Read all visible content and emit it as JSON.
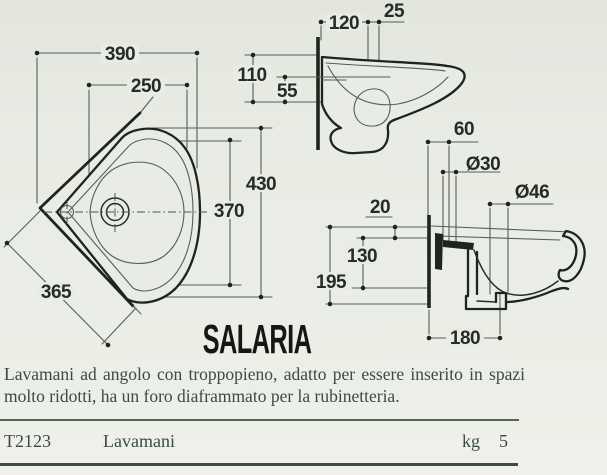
{
  "product": {
    "title": "SALARIA",
    "description": "Lavamani ad angolo con troppopieno, adatto per essere inserito in spazi molto ridotti, ha un foro diaframmato per la rubinetteria.",
    "table": {
      "code": "T2123",
      "name": "Lavamani",
      "unit_label": "kg",
      "weight": "5"
    }
  },
  "dimensions": {
    "plan": {
      "width": "390",
      "inner_width": "250",
      "depth": "430",
      "inner_depth": "370",
      "side": "365"
    },
    "side": {
      "tap_offset": "120",
      "tap_hole": "25",
      "height": "110",
      "lip": "55"
    },
    "section": {
      "drain_offset": "60",
      "drain_dia": "Ø30",
      "trap_dia": "Ø46",
      "fix_gap": "20",
      "drain_height": "130",
      "height": "195",
      "floor_offset": "180"
    }
  },
  "colors": {
    "page_background": "#e9ece4",
    "line_bold": "#20241f",
    "line_thin": "#555e58",
    "text_dark": "#3c4a44",
    "rule": "#57655f"
  }
}
